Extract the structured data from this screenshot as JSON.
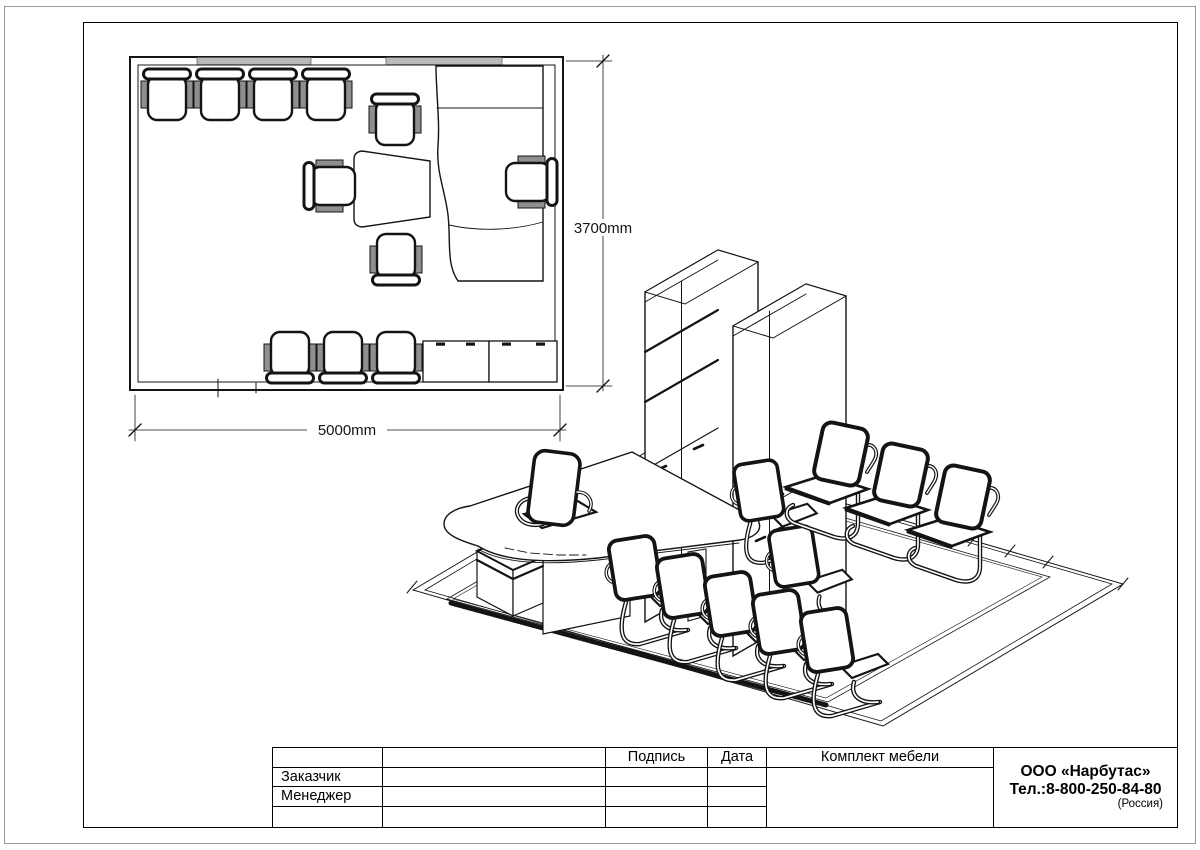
{
  "plan": {
    "width_label": "5000mm",
    "height_label": "3700mm"
  },
  "title_block": {
    "customer_label": "Заказчик",
    "manager_label": "Менеджер",
    "signature_header": "Подпись",
    "date_header": "Дата",
    "set_header": "Комплект мебели",
    "company_name": "ООО «Нарбутас»",
    "company_phone": "Тел.:8-800-250-84-80",
    "company_country": "(Россия)"
  },
  "colors": {
    "line": "#141414",
    "window_fill": "#b9b9b9",
    "armrest_fill": "#8f8f8f",
    "page_border": "#9a9a9a",
    "paper": "#ffffff"
  }
}
